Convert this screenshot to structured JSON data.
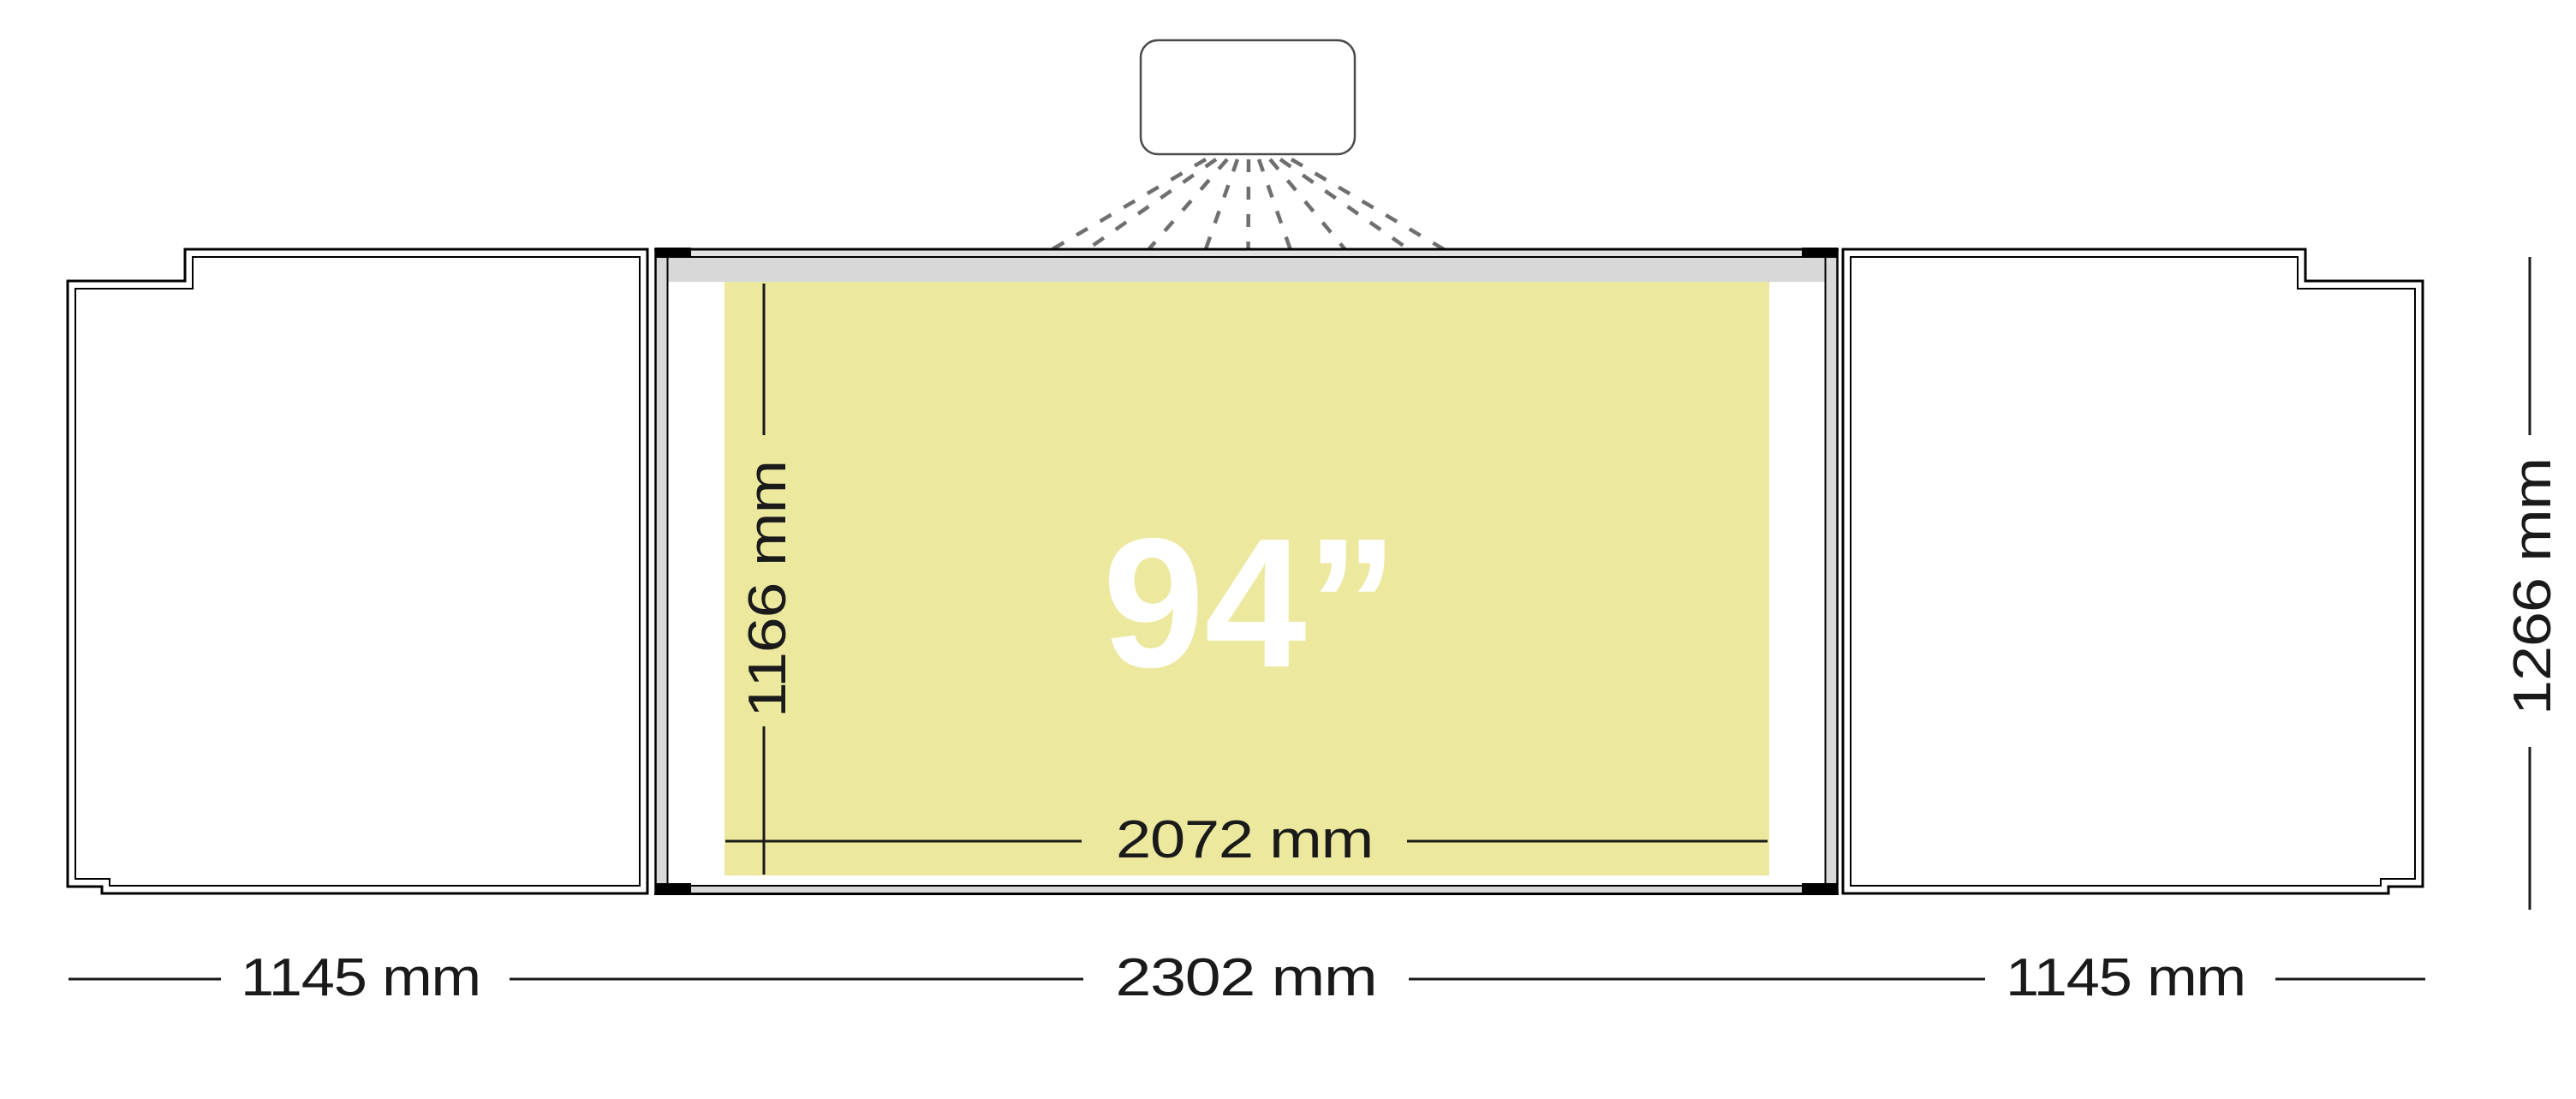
{
  "diagram": {
    "title": "projection-whiteboard-dimension-diagram",
    "projection_area": {
      "diagonal_label": "94”",
      "width_label": "2072 mm",
      "height_label": "1166 mm"
    },
    "board": {
      "width_label": "2302 mm",
      "height_label": "1266 mm"
    },
    "left_wing": {
      "width_label": "1145 mm"
    },
    "right_wing": {
      "width_label": "1145 mm"
    },
    "colors": {
      "projection_area_fill": "#ECE89E",
      "rail_gray": "#D8D8D8",
      "thin_rail_gray": "#E3E3E3",
      "outline_black": "#000000",
      "projection_ray_gray": "#6F6F6F",
      "dimension_text": "#1A1A1A",
      "diagonal_text": "#FFFFFF"
    }
  }
}
